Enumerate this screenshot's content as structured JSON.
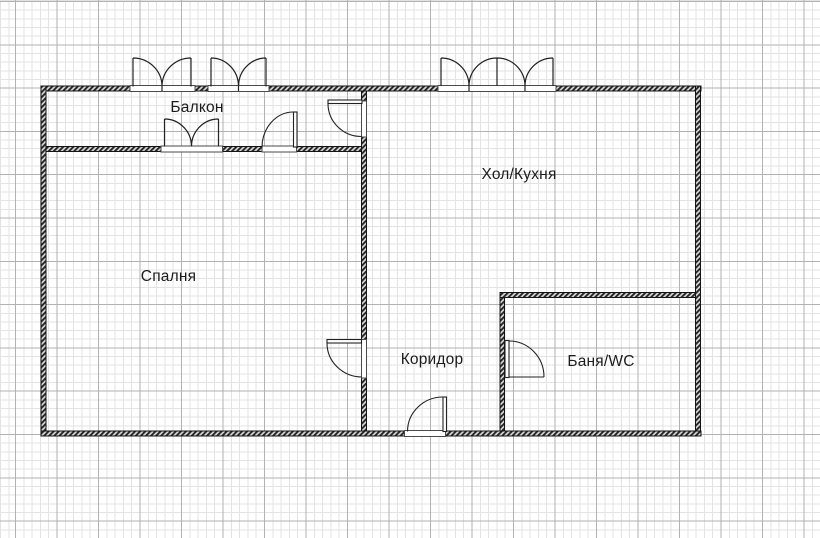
{
  "plan": {
    "rooms": [
      {
        "id": "balcony",
        "label": "Балкон"
      },
      {
        "id": "hall-kitchen",
        "label": "Хол/Кухня"
      },
      {
        "id": "bedroom",
        "label": "Спалня"
      },
      {
        "id": "corridor",
        "label": "Коридор"
      },
      {
        "id": "bathroom",
        "label": "Баня/WC"
      }
    ],
    "features": {
      "windows": [
        "balcony-exterior-window-left",
        "balcony-exterior-window-right",
        "hall-kitchen-exterior-window",
        "balcony-to-bedroom-window"
      ],
      "doors": [
        "balcony-to-hall-door",
        "balcony-to-bedroom-door",
        "bedroom-to-corridor-door",
        "entry-door",
        "bathroom-door"
      ]
    },
    "colors": {
      "background": "#ffffff",
      "grid_fine": "#e3e3e3",
      "grid_major": "#b2b2b2",
      "wall": "#1a1a1a",
      "text": "#1c1c1c"
    }
  }
}
